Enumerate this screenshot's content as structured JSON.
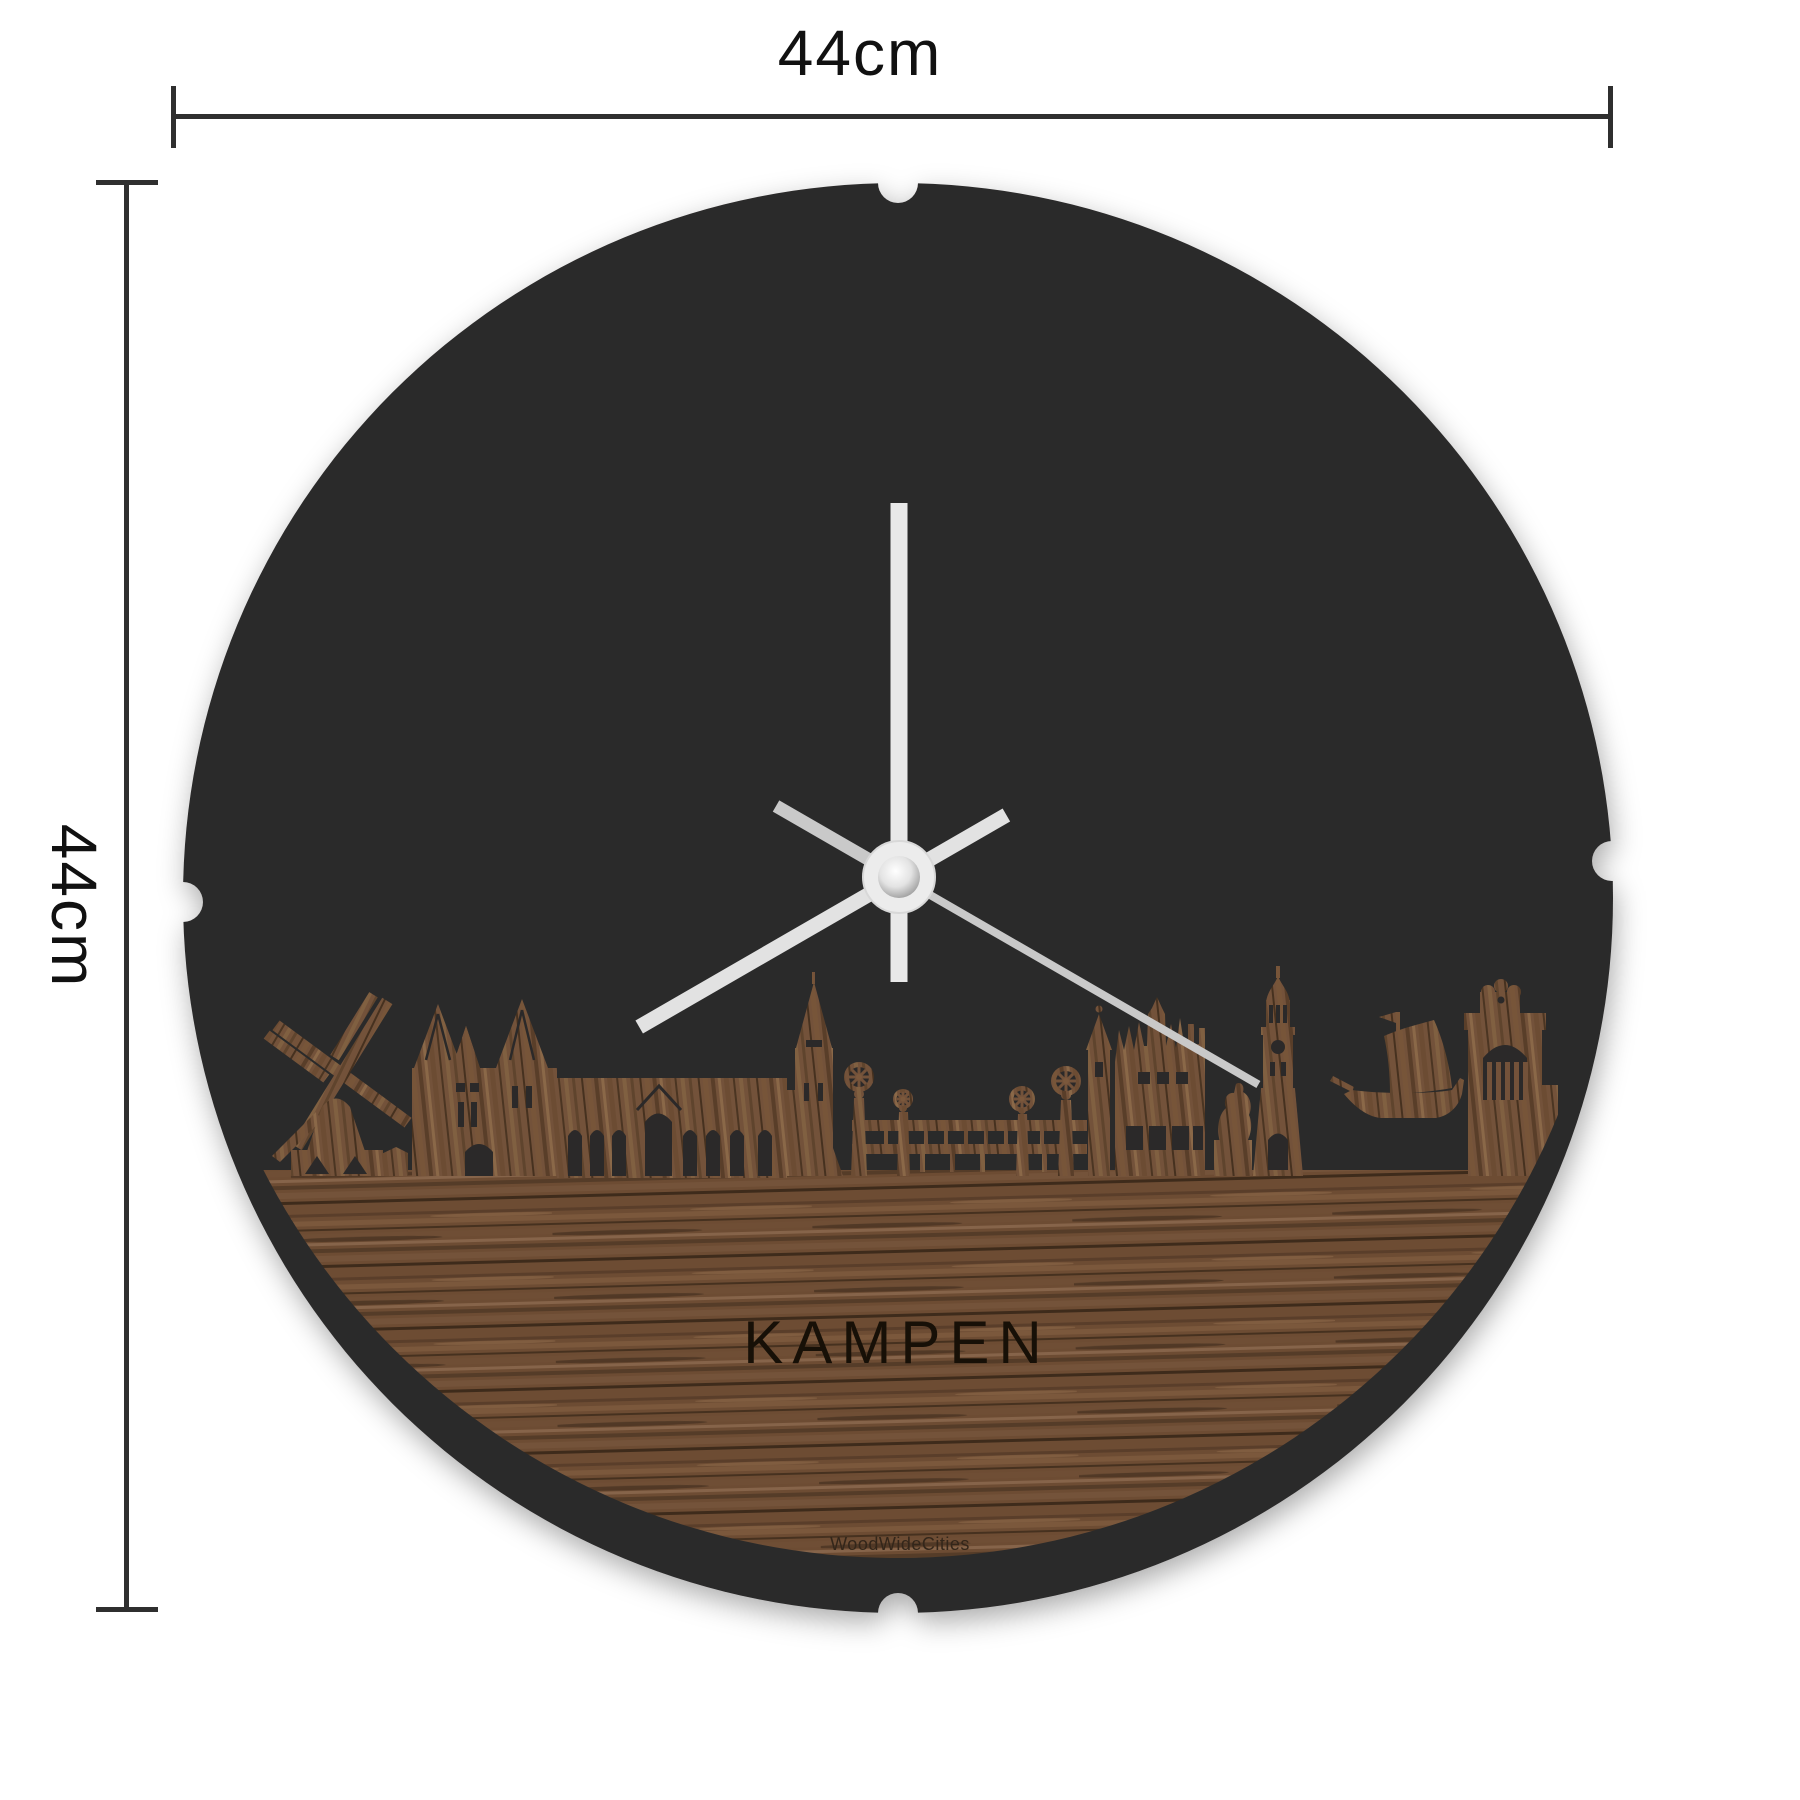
{
  "product": {
    "city_label": "KAMPEN",
    "brand_label": "WoodWideCities"
  },
  "dimensions": {
    "width_label": "44cm",
    "height_label": "44cm"
  },
  "colors": {
    "background": "#ffffff",
    "disc": "#2b2929",
    "wood_base": "#6d4c33",
    "wood_dark": "#3e2b1b",
    "wood_light": "#8f6b4a",
    "hand_light": "#e9e9e9",
    "hand_mid": "#e0e0e0",
    "second_hand": "#c9c9c9",
    "hub": "#ececec",
    "dimension_line": "#2f2f2f",
    "engrave": "#171007"
  },
  "clock": {
    "center": {
      "x": 899,
      "y": 877
    },
    "hands": [
      {
        "name": "minute-hand",
        "angle_deg": 0,
        "length": 374,
        "tail": 105,
        "width": 17,
        "tail_width": 17,
        "color": "#e9e9e9"
      },
      {
        "name": "hour-hand",
        "angle_deg": 240,
        "length": 300,
        "tail": 124,
        "width": 15,
        "tail_width": 15,
        "color": "#e2e2e2"
      },
      {
        "name": "second-hand",
        "angle_deg": 120,
        "length": 415,
        "tail": 142,
        "width": 8,
        "tail_width": 13,
        "color": "#c9c9c9"
      }
    ]
  }
}
